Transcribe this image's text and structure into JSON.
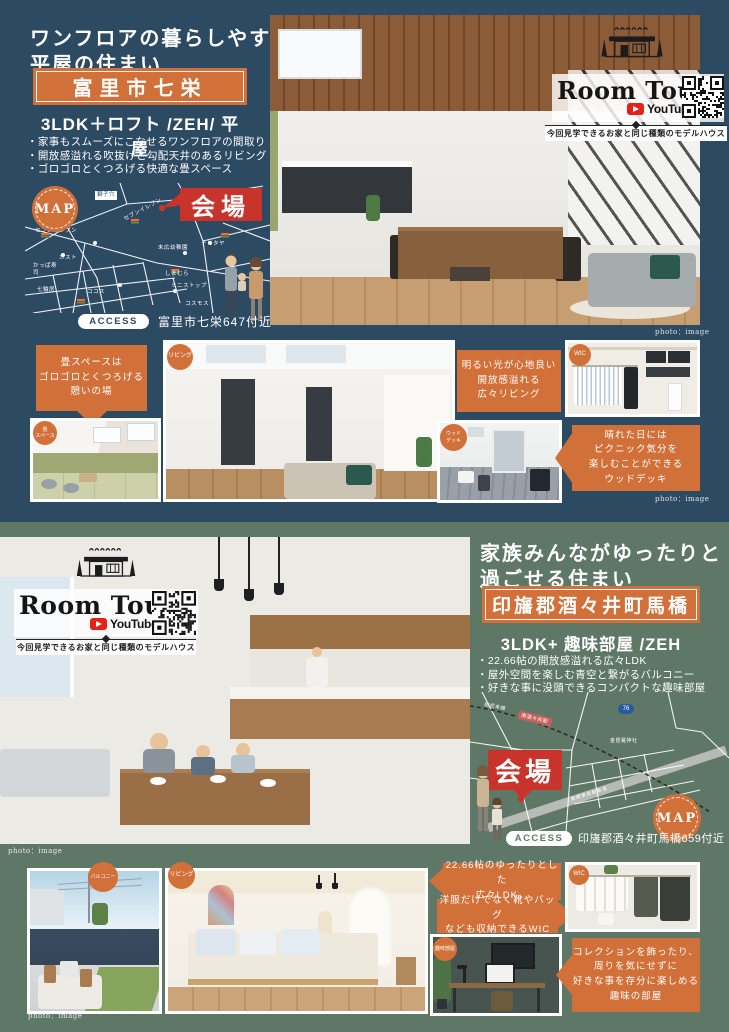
{
  "colors": {
    "navy": "#2d4a63",
    "green": "#5e7767",
    "orange": "#d2703a",
    "red": "#c8332b",
    "youtube_red": "#e62117"
  },
  "room_tour": {
    "title": "Room Tour",
    "youtube_label": "YouTube",
    "subtitle": "今回見学できるお家と同じ種類のモデルハウス"
  },
  "section1": {
    "title_line1": "ワンフロアの暮らしやすい",
    "title_line2": "平屋の住まい",
    "location": "富里市七栄",
    "spec": "3LDK＋ロフト /ZEH/ 平屋",
    "bullets": [
      "・家事もスムーズにこなせるワンフロアの間取り",
      "・開放感溢れる吹抜けと勾配天井のあるリビング",
      "・ゴロゴロとくつろげる快適な畳スペース"
    ],
    "photo_credit": "photo：image",
    "map": {
      "badge": "MAP",
      "venue": "会場",
      "labels": [
        "獅子穴",
        "セブンイレブン",
        "セブンイレブン",
        "ガスト",
        "かっぱ寿司",
        "七輪房",
        "ココス",
        "末広幼稚園",
        "ナリタヤ",
        "しまむら",
        "ミニストップ",
        "コスモス"
      ],
      "access_label": "ACCESS",
      "access_text": "富里市七栄647付近"
    },
    "gallery": {
      "callout_tatami": "畳スペースは\nゴロゴロとくつろげる\n憩いの場",
      "label_tatami": "畳\nスペース",
      "label_living": "リビング",
      "callout_living": "明るい光が心地良い\n開放感溢れる\n広々リビング",
      "label_wic": "WIC",
      "label_deck": "ウッド\nデッキ",
      "callout_deck": "晴れた日には\nピクニック気分を\n楽しむことができる\nウッドデッキ",
      "photo_credit": "photo：image"
    }
  },
  "section2": {
    "title_line1": "家族みんながゆったりと",
    "title_line2": "過ごせる住まい",
    "location": "印旛郡酒々井町馬橋",
    "spec": "3LDK+ 趣味部屋 /ZEH",
    "bullets": [
      "・22.66帖の開放感溢れる広々LDK",
      "・屋外空間を楽しむ青空と繋がるバルコニー",
      "・好きな事に没頭できるコンパクトな趣味部屋"
    ],
    "photo_credit": "photo：image",
    "map": {
      "badge": "MAP",
      "venue": "会場",
      "rail_line": "総武本線",
      "station": "南酒々井駅",
      "shrine": "金毘羅神社",
      "highway": "東関東自動車道",
      "route": "76",
      "access_label": "ACCESS",
      "access_text": "印旛郡酒々井町馬橋659付近"
    },
    "gallery": {
      "label_balcony": "バルコニー",
      "label_living": "リビング",
      "callout_ldk": "22.66帖のゆったりとした\n広々LDK。",
      "callout_wic": "洋服だけでなく靴やバッグ\nなども収納できるWIC",
      "label_wic": "WIC",
      "label_hobby": "趣味部屋",
      "callout_hobby": "コレクションを飾ったり、\n周りを気にせずに\n好きな事を存分に楽しめる\n趣味の部屋",
      "photo_credit": "photo：image"
    }
  }
}
